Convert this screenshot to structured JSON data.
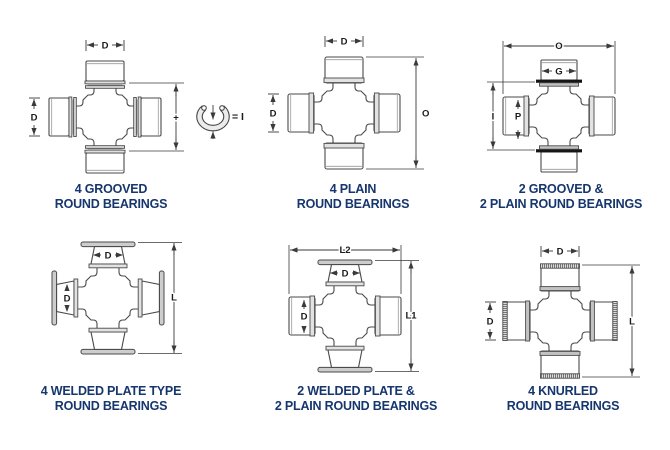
{
  "page": {
    "background": "#ffffff",
    "caption_color": "#16366e",
    "line_color": "#4a4a4a"
  },
  "figures": [
    {
      "id": "4-grooved-round-bearings",
      "caption_line1": "4 GROOVED",
      "caption_line2": "ROUND BEARINGS",
      "bearing_style": "grooved",
      "labels": {
        "top_width": "D",
        "left_diameter": "D",
        "right_span": "+",
        "snap_ring_equals": "= I"
      }
    },
    {
      "id": "4-plain-round-bearings",
      "caption_line1": "4 PLAIN",
      "caption_line2": "ROUND BEARINGS",
      "bearing_style": "plain",
      "labels": {
        "top_width": "D",
        "left_diameter": "D",
        "right_span": "O"
      }
    },
    {
      "id": "2-grooved-2-plain-round-bearings",
      "caption_line1": "2 GROOVED &",
      "caption_line2": "2 PLAIN ROUND BEARINGS",
      "bearing_style": "grooved+plain",
      "labels": {
        "top_span": "O",
        "cup_width": "G",
        "left_span": "I",
        "cup_diameter": "P"
      }
    },
    {
      "id": "4-welded-plate-round-bearings",
      "caption_line1": "4 WELDED PLATE TYPE",
      "caption_line2": "ROUND BEARINGS",
      "bearing_style": "welded-plate",
      "labels": {
        "cup_width": "D",
        "cup_diameter": "D",
        "right_span": "L"
      }
    },
    {
      "id": "2-welded-plate-2-plain-round-bearings",
      "caption_line1": "2 WELDED PLATE &",
      "caption_line2": "2 PLAIN ROUND BEARINGS",
      "bearing_style": "welded-plate+plain",
      "labels": {
        "top_span": "L2",
        "cup_width": "D",
        "cup_diameter": "D",
        "right_span": "L1"
      }
    },
    {
      "id": "4-knurled-round-bearings",
      "caption_line1": "4 KNURLED",
      "caption_line2": "ROUND BEARINGS",
      "bearing_style": "knurled",
      "labels": {
        "top_width": "D",
        "left_diameter": "D",
        "right_span": "L"
      }
    }
  ]
}
